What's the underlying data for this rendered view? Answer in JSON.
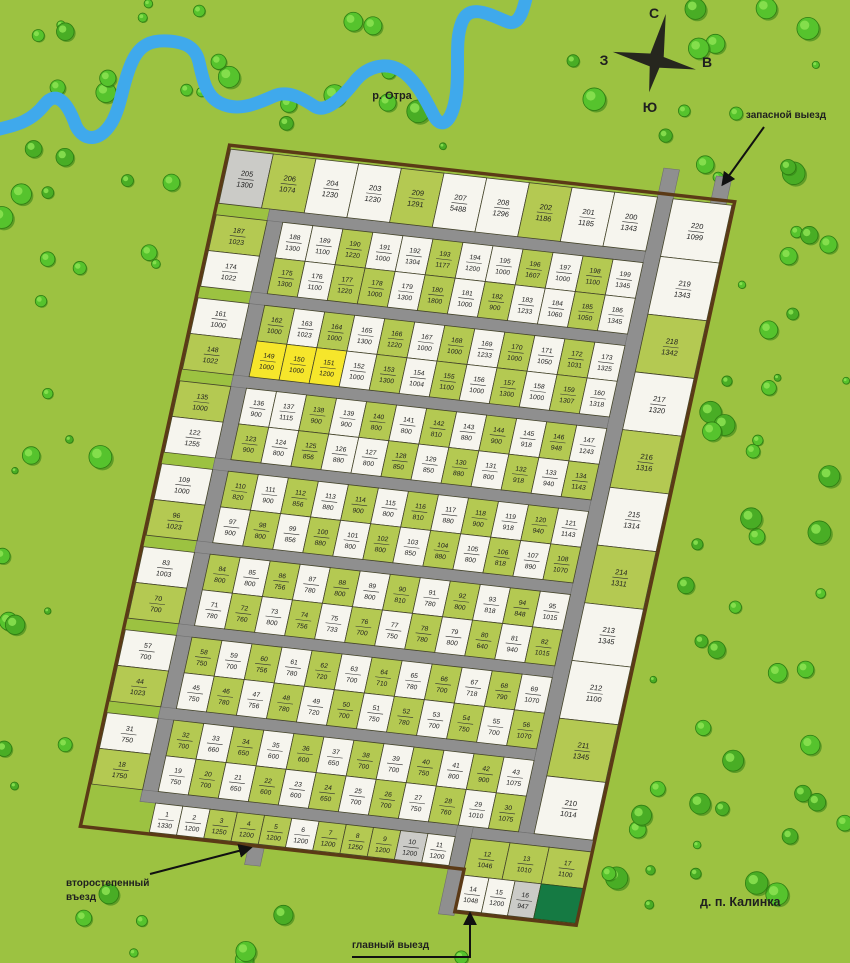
{
  "map_title": "д. п. Калинка",
  "river": {
    "label": "р. Отра"
  },
  "compass": {
    "north": "С",
    "south": "Ю",
    "west": "З",
    "east": "В"
  },
  "labels": {
    "reserve_exit": "запасной выезд",
    "secondary_entrance_line1": "второстепенный",
    "secondary_entrance_line2": "въезд",
    "main_exit": "главный выезд",
    "village": "д. п. Калинка"
  },
  "colors": {
    "grass": "#9cc241",
    "plot_green": "#b4c952",
    "plot_white": "#f6f5ee",
    "plot_yellow": "#f6e62b",
    "plot_gray": "#cbcbc7",
    "plot_darkgreen": "#157a43",
    "road": "#8f8f8f",
    "road_edge": "#6f6f6f",
    "boundary": "#5b3a16",
    "river": "#3fa9ec",
    "tree": "#56c32d",
    "tree_dark": "#2e7d12",
    "tree_light": "#8ce352",
    "text": "#1f1f1f"
  },
  "plots": {
    "top_row": [
      [
        205,
        1300,
        "gy"
      ],
      [
        206,
        1074,
        "g"
      ],
      [
        204,
        1230,
        "w"
      ],
      [
        203,
        1230,
        "w"
      ],
      [
        209,
        1291,
        "g"
      ],
      [
        207,
        5488,
        "w"
      ],
      [
        208,
        1296,
        "w"
      ],
      [
        202,
        1186,
        "g"
      ],
      [
        201,
        1185,
        "w"
      ],
      [
        200,
        1343,
        "w"
      ]
    ],
    "right_column": [
      [
        220,
        1099,
        "w"
      ],
      [
        219,
        1343,
        "w"
      ],
      [
        218,
        1342,
        "g"
      ],
      [
        217,
        1320,
        "w"
      ],
      [
        216,
        1316,
        "g"
      ],
      [
        215,
        1314,
        "w"
      ],
      [
        214,
        1311,
        "g"
      ],
      [
        213,
        1345,
        "w"
      ],
      [
        212,
        1100,
        "w"
      ],
      [
        211,
        1345,
        "g"
      ],
      [
        210,
        1014,
        "w"
      ]
    ],
    "bands": [
      {
        "upper": [
          [
            187,
            1023,
            "g"
          ],
          [
            188,
            1300,
            "w"
          ],
          [
            189,
            1100,
            "w"
          ],
          [
            190,
            1220,
            "g"
          ],
          [
            191,
            1000,
            "w"
          ],
          [
            192,
            1304,
            "w"
          ],
          [
            193,
            1177,
            "g"
          ],
          [
            194,
            1200,
            "w"
          ],
          [
            195,
            1000,
            "w"
          ],
          [
            196,
            1607,
            "g"
          ],
          [
            197,
            1000,
            "w"
          ],
          [
            198,
            1100,
            "g"
          ],
          [
            199,
            1345,
            "w"
          ]
        ],
        "lower": [
          [
            174,
            1022,
            "w"
          ],
          [
            175,
            1300,
            "g"
          ],
          [
            176,
            1100,
            "w"
          ],
          [
            177,
            1220,
            "g"
          ],
          [
            178,
            1000,
            "g"
          ],
          [
            179,
            1300,
            "w"
          ],
          [
            180,
            1800,
            "g"
          ],
          [
            181,
            1000,
            "w"
          ],
          [
            182,
            900,
            "g"
          ],
          [
            183,
            1233,
            "w"
          ],
          [
            184,
            1060,
            "w"
          ],
          [
            185,
            1050,
            "g"
          ],
          [
            186,
            1345,
            "w"
          ]
        ]
      },
      {
        "upper": [
          [
            161,
            1000,
            "w"
          ],
          [
            162,
            1000,
            "g"
          ],
          [
            163,
            1023,
            "w"
          ],
          [
            164,
            1000,
            "g"
          ],
          [
            165,
            1300,
            "w"
          ],
          [
            166,
            1220,
            "g"
          ],
          [
            167,
            1000,
            "w"
          ],
          [
            168,
            1000,
            "g"
          ],
          [
            169,
            1233,
            "w"
          ],
          [
            170,
            1000,
            "g"
          ],
          [
            171,
            1050,
            "w"
          ],
          [
            172,
            1031,
            "g"
          ],
          [
            173,
            1325,
            "w"
          ]
        ],
        "lower": [
          [
            148,
            1022,
            "g"
          ],
          [
            149,
            1000,
            "y"
          ],
          [
            150,
            1000,
            "y"
          ],
          [
            151,
            1200,
            "y"
          ],
          [
            152,
            1000,
            "w"
          ],
          [
            153,
            1300,
            "g"
          ],
          [
            154,
            1004,
            "w"
          ],
          [
            155,
            1100,
            "g"
          ],
          [
            156,
            1000,
            "w"
          ],
          [
            157,
            1300,
            "g"
          ],
          [
            158,
            1000,
            "w"
          ],
          [
            159,
            1307,
            "g"
          ],
          [
            160,
            1318,
            "w"
          ]
        ]
      },
      {
        "upper": [
          [
            135,
            1000,
            "g"
          ],
          [
            136,
            900,
            "w"
          ],
          [
            137,
            1115,
            "w"
          ],
          [
            138,
            900,
            "g"
          ],
          [
            139,
            900,
            "w"
          ],
          [
            140,
            800,
            "g"
          ],
          [
            141,
            800,
            "w"
          ],
          [
            142,
            810,
            "g"
          ],
          [
            143,
            880,
            "w"
          ],
          [
            144,
            900,
            "g"
          ],
          [
            145,
            918,
            "w"
          ],
          [
            146,
            948,
            "g"
          ],
          [
            147,
            1243,
            "w"
          ]
        ],
        "lower": [
          [
            122,
            1255,
            "w"
          ],
          [
            123,
            900,
            "g"
          ],
          [
            124,
            800,
            "w"
          ],
          [
            125,
            856,
            "g"
          ],
          [
            126,
            880,
            "w"
          ],
          [
            127,
            800,
            "w"
          ],
          [
            128,
            850,
            "g"
          ],
          [
            129,
            850,
            "w"
          ],
          [
            130,
            880,
            "g"
          ],
          [
            131,
            800,
            "w"
          ],
          [
            132,
            918,
            "g"
          ],
          [
            133,
            940,
            "w"
          ],
          [
            134,
            1143,
            "g"
          ]
        ]
      },
      {
        "upper": [
          [
            109,
            1000,
            "w"
          ],
          [
            110,
            820,
            "g"
          ],
          [
            111,
            900,
            "w"
          ],
          [
            112,
            856,
            "g"
          ],
          [
            113,
            880,
            "w"
          ],
          [
            114,
            900,
            "g"
          ],
          [
            115,
            800,
            "w"
          ],
          [
            116,
            810,
            "g"
          ],
          [
            117,
            880,
            "w"
          ],
          [
            118,
            900,
            "g"
          ],
          [
            119,
            918,
            "w"
          ],
          [
            120,
            940,
            "g"
          ],
          [
            121,
            1143,
            "w"
          ]
        ],
        "lower": [
          [
            96,
            1023,
            "g"
          ],
          [
            97,
            900,
            "w"
          ],
          [
            98,
            800,
            "g"
          ],
          [
            99,
            856,
            "w"
          ],
          [
            100,
            880,
            "g"
          ],
          [
            101,
            800,
            "w"
          ],
          [
            102,
            800,
            "g"
          ],
          [
            103,
            850,
            "w"
          ],
          [
            104,
            880,
            "g"
          ],
          [
            105,
            800,
            "w"
          ],
          [
            106,
            818,
            "g"
          ],
          [
            107,
            890,
            "w"
          ],
          [
            108,
            1070,
            "g"
          ]
        ]
      },
      {
        "upper": [
          [
            83,
            1003,
            "w"
          ],
          [
            84,
            800,
            "g"
          ],
          [
            85,
            800,
            "w"
          ],
          [
            86,
            756,
            "g"
          ],
          [
            87,
            780,
            "w"
          ],
          [
            88,
            800,
            "g"
          ],
          [
            89,
            800,
            "w"
          ],
          [
            90,
            810,
            "g"
          ],
          [
            91,
            780,
            "w"
          ],
          [
            92,
            800,
            "g"
          ],
          [
            93,
            818,
            "w"
          ],
          [
            94,
            848,
            "g"
          ],
          [
            95,
            1015,
            "w"
          ]
        ],
        "lower": [
          [
            70,
            700,
            "g"
          ],
          [
            71,
            780,
            "w"
          ],
          [
            72,
            760,
            "g"
          ],
          [
            73,
            800,
            "w"
          ],
          [
            74,
            756,
            "g"
          ],
          [
            75,
            733,
            "w"
          ],
          [
            76,
            700,
            "g"
          ],
          [
            77,
            750,
            "w"
          ],
          [
            78,
            780,
            "g"
          ],
          [
            79,
            800,
            "w"
          ],
          [
            80,
            640,
            "g"
          ],
          [
            81,
            940,
            "w"
          ],
          [
            82,
            1015,
            "g"
          ]
        ]
      },
      {
        "upper": [
          [
            57,
            700,
            "w"
          ],
          [
            58,
            750,
            "g"
          ],
          [
            59,
            700,
            "w"
          ],
          [
            60,
            756,
            "g"
          ],
          [
            61,
            780,
            "w"
          ],
          [
            62,
            720,
            "g"
          ],
          [
            63,
            700,
            "w"
          ],
          [
            64,
            710,
            "g"
          ],
          [
            65,
            780,
            "w"
          ],
          [
            66,
            700,
            "g"
          ],
          [
            67,
            718,
            "w"
          ],
          [
            68,
            790,
            "g"
          ],
          [
            69,
            1070,
            "w"
          ]
        ],
        "lower": [
          [
            44,
            1023,
            "g"
          ],
          [
            45,
            750,
            "w"
          ],
          [
            46,
            780,
            "g"
          ],
          [
            47,
            756,
            "w"
          ],
          [
            48,
            780,
            "g"
          ],
          [
            49,
            720,
            "w"
          ],
          [
            50,
            700,
            "g"
          ],
          [
            51,
            750,
            "w"
          ],
          [
            52,
            780,
            "g"
          ],
          [
            53,
            700,
            "w"
          ],
          [
            54,
            750,
            "g"
          ],
          [
            55,
            700,
            "w"
          ],
          [
            56,
            1070,
            "g"
          ]
        ]
      },
      {
        "upper": [
          [
            31,
            750,
            "w"
          ],
          [
            32,
            700,
            "g"
          ],
          [
            33,
            660,
            "w"
          ],
          [
            34,
            650,
            "g"
          ],
          [
            35,
            600,
            "w"
          ],
          [
            36,
            600,
            "g"
          ],
          [
            37,
            650,
            "w"
          ],
          [
            38,
            700,
            "g"
          ],
          [
            39,
            700,
            "w"
          ],
          [
            40,
            750,
            "g"
          ],
          [
            41,
            800,
            "w"
          ],
          [
            42,
            900,
            "g"
          ],
          [
            43,
            1075,
            "w"
          ]
        ],
        "lower": [
          [
            18,
            1750,
            "g"
          ],
          [
            19,
            750,
            "w"
          ],
          [
            20,
            700,
            "g"
          ],
          [
            21,
            650,
            "w"
          ],
          [
            22,
            600,
            "g"
          ],
          [
            23,
            600,
            "w"
          ],
          [
            24,
            650,
            "g"
          ],
          [
            25,
            700,
            "w"
          ],
          [
            26,
            700,
            "g"
          ],
          [
            27,
            750,
            "w"
          ],
          [
            28,
            760,
            "g"
          ],
          [
            29,
            1010,
            "w"
          ],
          [
            30,
            1075,
            "g"
          ]
        ]
      }
    ],
    "bottom_row": [
      [
        1,
        1330,
        "w"
      ],
      [
        2,
        1200,
        "w"
      ],
      [
        3,
        1250,
        "g"
      ],
      [
        4,
        1200,
        "g"
      ],
      [
        5,
        1200,
        "g"
      ],
      [
        6,
        1200,
        "w"
      ],
      [
        7,
        1200,
        "g"
      ],
      [
        8,
        1250,
        "g"
      ],
      [
        9,
        1200,
        "g"
      ],
      [
        10,
        1200,
        "gy"
      ],
      [
        11,
        1200,
        "w"
      ]
    ],
    "se_row_upper": [
      [
        12,
        1046,
        "g"
      ],
      [
        13,
        1010,
        "g"
      ],
      [
        17,
        1100,
        "g"
      ]
    ],
    "se_row_lower": [
      [
        14,
        1048,
        "w"
      ],
      [
        15,
        1200,
        "w"
      ],
      [
        16,
        947,
        "gy"
      ]
    ],
    "dark_green_plot": {
      "label": ""
    }
  }
}
